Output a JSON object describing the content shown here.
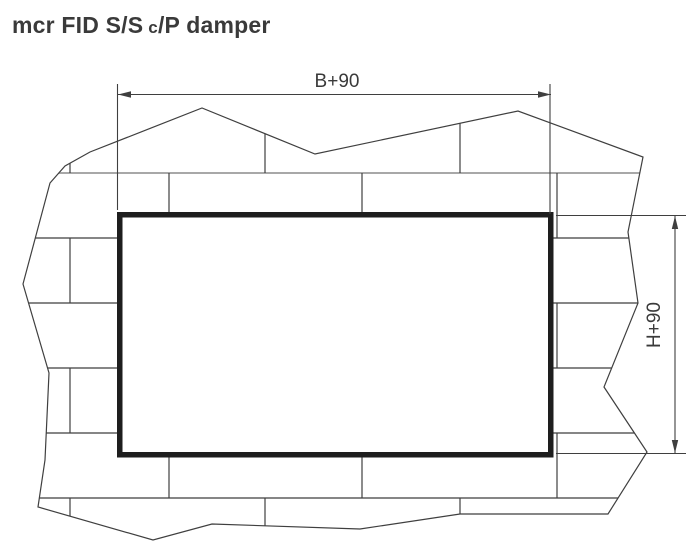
{
  "title": {
    "prefix": "mcr FID S/S",
    "subscript": "c",
    "suffix": "/P damper"
  },
  "dimensions": {
    "width_label": "B+90",
    "height_label": "H+90"
  },
  "colors": {
    "line": "#3f3f3f",
    "mortar_light": "#a8a8a8",
    "damper_frame": "#1e1e1e",
    "text": "#3a3a3a",
    "background": "#ffffff"
  }
}
